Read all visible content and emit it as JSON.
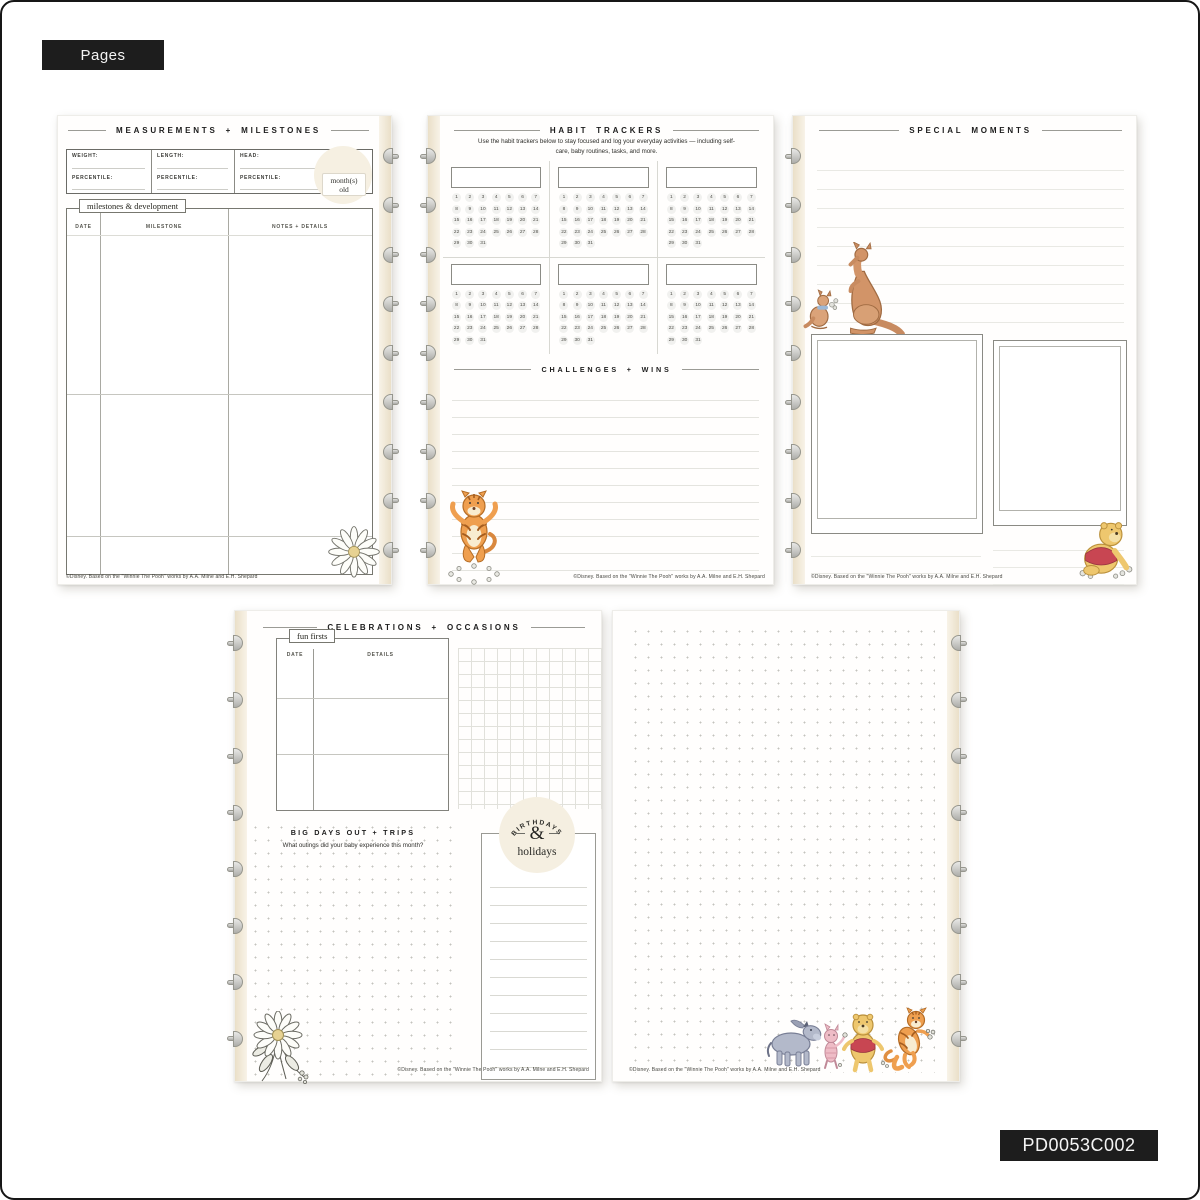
{
  "tags": {
    "top": "Pages",
    "bottom": "PD0053C002"
  },
  "footer_copyright": "©Disney. Based on the \"Winnie The Pooh\" works by A.A. Milne and E.H. Shepard",
  "colors": {
    "accent_black": "#1d1d1d",
    "page_cream": "#f5efe2",
    "disc_gray": "#b5b5b1",
    "pooh_yellow": "#eec76e",
    "tigger_orange": "#ef9f4f",
    "shirt_red": "#c84652",
    "kanga_brown": "#d29468",
    "eeyore_gray": "#b3b9ca",
    "piglet_pink": "#eebcc6"
  },
  "pages": {
    "measurements": {
      "title": "MEASUREMENTS + MILESTONES",
      "fields": [
        {
          "top": "WEIGHT:",
          "bottom": "PERCENTILE:"
        },
        {
          "top": "LENGTH:",
          "bottom": "PERCENTILE:"
        },
        {
          "top": "HEAD:",
          "bottom": "PERCENTILE:"
        }
      ],
      "age_badge": {
        "line1": "month(s)",
        "line2": "old"
      },
      "section_label": "milestones & development",
      "columns": [
        "DATE",
        "MILESTONE",
        "NOTES + DETAILS"
      ]
    },
    "habits": {
      "title": "HABIT TRACKERS",
      "subtitle": "Use the habit trackers below to stay focused and log your everyday activities — including self-care, baby routines, tasks, and more.",
      "days": [
        1,
        2,
        3,
        4,
        5,
        6,
        7,
        8,
        9,
        10,
        11,
        12,
        13,
        14,
        15,
        16,
        17,
        18,
        19,
        20,
        21,
        22,
        23,
        24,
        25,
        26,
        27,
        28,
        29,
        30,
        31
      ],
      "challenges_title": "CHALLENGES + WINS"
    },
    "moments": {
      "title": "SPECIAL MOMENTS"
    },
    "celebrations": {
      "title": "CELEBRATIONS + OCCASIONS",
      "fun_firsts_label": "fun firsts",
      "columns": [
        "DATE",
        "DETAILS"
      ],
      "big_days_title": "BIG DAYS OUT + TRIPS",
      "big_days_subtitle": "What outings did your baby experience this month?",
      "badge": {
        "arc": "BIRTHDAYS",
        "amp": "&",
        "word": "holidays"
      }
    },
    "dotgrid": {}
  }
}
